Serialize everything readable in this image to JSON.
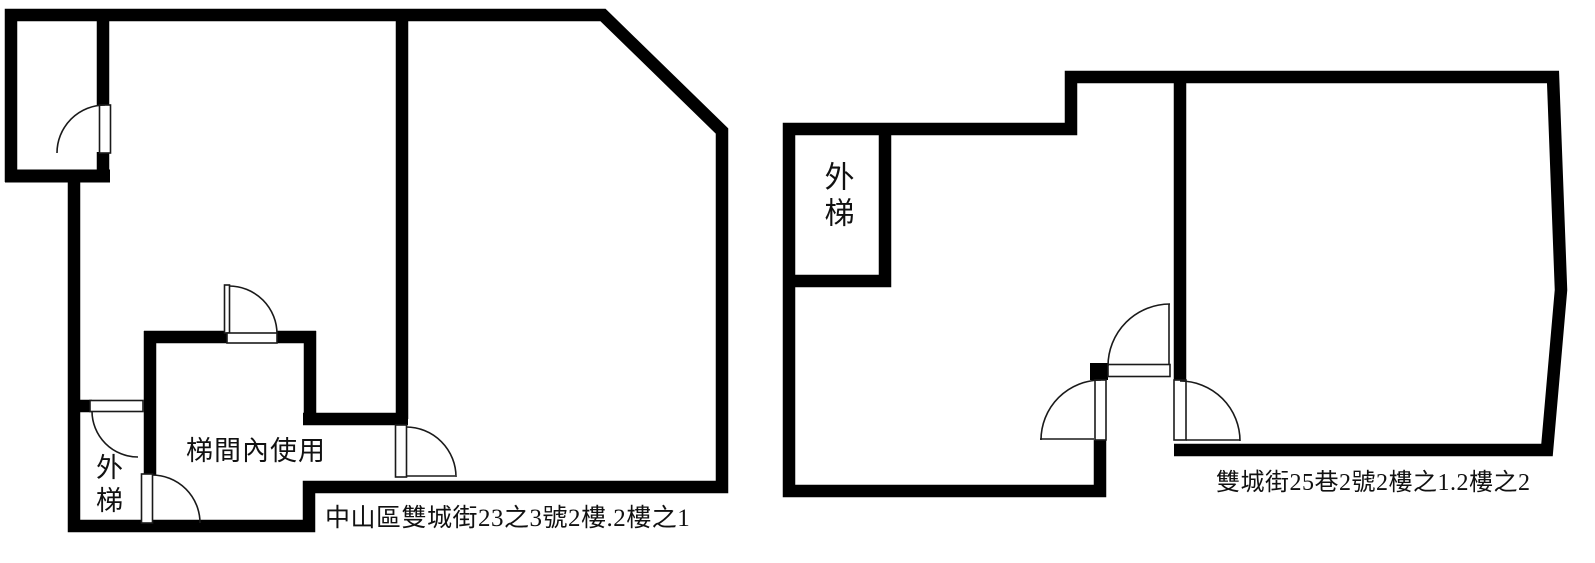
{
  "page": {
    "background_color": "#ffffff",
    "wall_color": "#000000",
    "text_color": "#111111"
  },
  "left_plan": {
    "caption": "中山區雙城街23之3號2樓.2樓之1",
    "stairwell_room_label": "梯間內使用",
    "external_stair_label": "外梯"
  },
  "right_plan": {
    "caption": "雙城街25巷2號2樓之1.2樓之2",
    "external_stair_label": "外梯"
  }
}
